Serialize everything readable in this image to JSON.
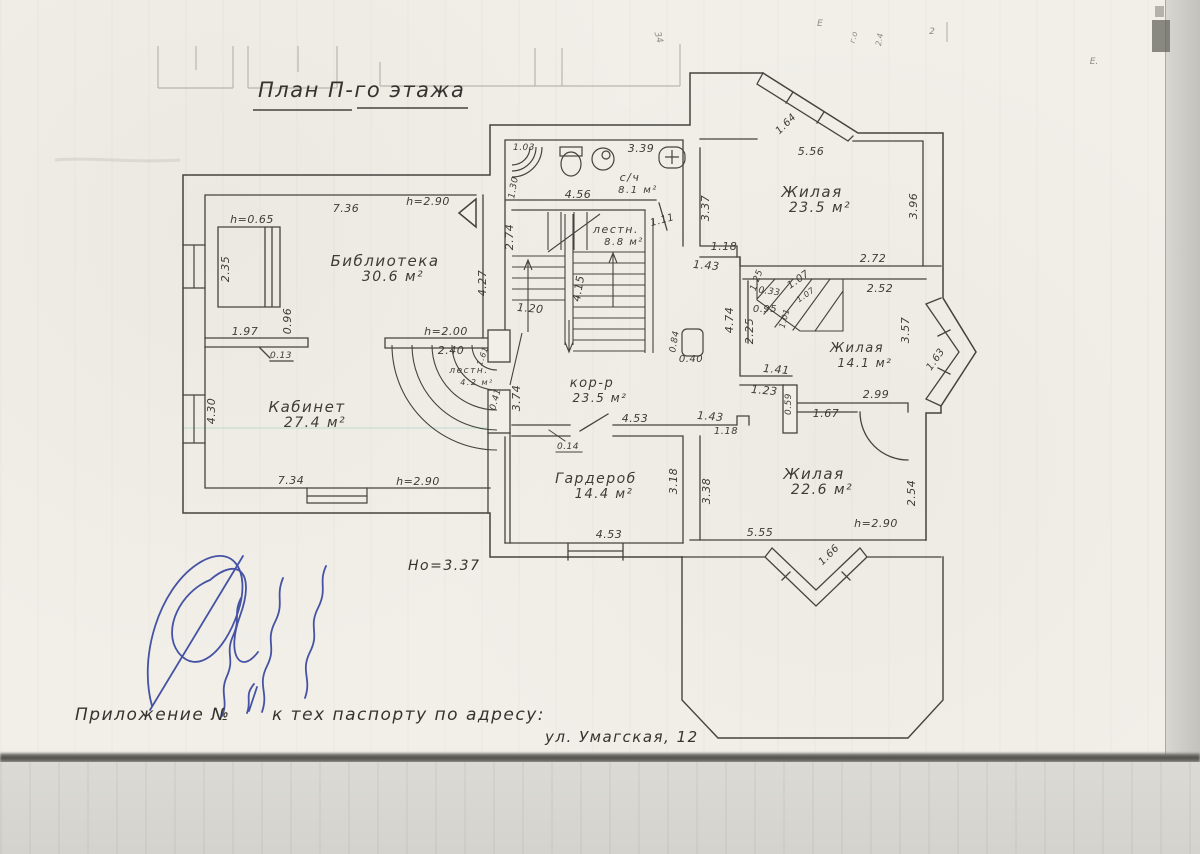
{
  "page": {
    "title": "План П-го этажа",
    "note": "Но=3.37",
    "caption_prefix": "Приложение №",
    "caption_suffix": "к тех паспорту по адресу:",
    "caption_address": "ул. Умагская, 12"
  },
  "colors": {
    "ink": "#44433e",
    "blue_ink": "#2e3e9b",
    "paper": "#f1efe8"
  },
  "rooms": [
    {
      "name": "Библиотека",
      "area": "30.6 м²",
      "x": 385,
      "y": 266,
      "fs": 15
    },
    {
      "name": "Кабинет",
      "area": "27.4 м²",
      "x": 307,
      "y": 412,
      "fs": 15
    },
    {
      "name": "с/ч",
      "area": "8.1 м²",
      "x": 630,
      "y": 181,
      "fs": 11
    },
    {
      "name": "лестн.",
      "area": "8.8 м²",
      "x": 616,
      "y": 233,
      "fs": 11
    },
    {
      "name": "лестн.",
      "area": "4.2 м²",
      "x": 469,
      "y": 373,
      "fs": 9
    },
    {
      "name": "Жилая",
      "area": "23.5 м²",
      "x": 812,
      "y": 197,
      "fs": 15
    },
    {
      "name": "Жилая",
      "area": "14.1 м²",
      "x": 857,
      "y": 352,
      "fs": 13
    },
    {
      "name": "Жилая",
      "area": "22.6 м²",
      "x": 814,
      "y": 479,
      "fs": 15
    },
    {
      "name": "Гардероб",
      "area": "14.4 м²",
      "x": 596,
      "y": 483,
      "fs": 14
    },
    {
      "name": "кор-р",
      "area": "23.5 м²",
      "x": 592,
      "y": 387,
      "fs": 13
    }
  ],
  "dims": [
    {
      "t": "7.36",
      "x": 346,
      "y": 212
    },
    {
      "t": "h=2.90",
      "x": 428,
      "y": 205
    },
    {
      "t": "h=0.65",
      "x": 252,
      "y": 223
    },
    {
      "t": "2.35",
      "x": 229,
      "y": 269,
      "r": -90
    },
    {
      "t": "0.96",
      "x": 291,
      "y": 321,
      "r": -90
    },
    {
      "t": "1.97",
      "x": 245,
      "y": 335
    },
    {
      "t": "0.13",
      "x": 281,
      "y": 358,
      "fs": 9
    },
    {
      "t": "h=2.00",
      "x": 446,
      "y": 335
    },
    {
      "t": "2.40",
      "x": 451,
      "y": 354
    },
    {
      "t": "4.27",
      "x": 486,
      "y": 283,
      "r": -90
    },
    {
      "t": "1.61",
      "x": 485,
      "y": 357,
      "r": -70,
      "fs": 8
    },
    {
      "t": "4.30",
      "x": 215,
      "y": 411,
      "r": -90
    },
    {
      "t": "7.34",
      "x": 291,
      "y": 484
    },
    {
      "t": "h=2.90",
      "x": 418,
      "y": 485
    },
    {
      "t": "1.03",
      "x": 524,
      "y": 150,
      "fs": 9
    },
    {
      "t": "1.30",
      "x": 516,
      "y": 188,
      "r": -80,
      "fs": 9
    },
    {
      "t": "3.39",
      "x": 641,
      "y": 152
    },
    {
      "t": "4.56",
      "x": 578,
      "y": 198
    },
    {
      "t": "1.11",
      "x": 663,
      "y": 223,
      "r": -15,
      "fs": 10
    },
    {
      "t": "2.74",
      "x": 513,
      "y": 237,
      "r": -90
    },
    {
      "t": "1.20",
      "x": 530,
      "y": 312,
      "r": 5
    },
    {
      "t": "4.15",
      "x": 582,
      "y": 289,
      "r": -80
    },
    {
      "t": "0.41",
      "x": 498,
      "y": 400,
      "r": -75,
      "fs": 9
    },
    {
      "t": "3.74",
      "x": 520,
      "y": 398,
      "r": -90
    },
    {
      "t": "0.84",
      "x": 677,
      "y": 342,
      "r": -80,
      "fs": 9
    },
    {
      "t": "0.40",
      "x": 691,
      "y": 362,
      "fs": 10
    },
    {
      "t": "4.74",
      "x": 733,
      "y": 320,
      "r": -90
    },
    {
      "t": "2.25",
      "x": 753,
      "y": 331,
      "r": -90
    },
    {
      "t": "0.95",
      "x": 765,
      "y": 312,
      "fs": 10
    },
    {
      "t": "0.33",
      "x": 769,
      "y": 294,
      "r": 8,
      "fs": 9
    },
    {
      "t": "1.07",
      "x": 800,
      "y": 282,
      "r": -35,
      "fs": 10
    },
    {
      "t": "1.07",
      "x": 807,
      "y": 297,
      "r": -35,
      "fs": 8
    },
    {
      "t": "1.01",
      "x": 787,
      "y": 319,
      "r": -75,
      "fs": 8
    },
    {
      "t": "1.25",
      "x": 759,
      "y": 281,
      "r": -70,
      "fs": 9
    },
    {
      "t": "3.37",
      "x": 709,
      "y": 208,
      "r": -90
    },
    {
      "t": "5.56",
      "x": 811,
      "y": 155
    },
    {
      "t": "1.64",
      "x": 788,
      "y": 126,
      "r": -45,
      "fs": 10
    },
    {
      "t": "3.96",
      "x": 917,
      "y": 206,
      "r": -90
    },
    {
      "t": "1.18",
      "x": 724,
      "y": 250
    },
    {
      "t": "1.43",
      "x": 706,
      "y": 269,
      "r": 5
    },
    {
      "t": "2.72",
      "x": 873,
      "y": 262
    },
    {
      "t": "2.52",
      "x": 880,
      "y": 292
    },
    {
      "t": "3.57",
      "x": 909,
      "y": 330,
      "r": -90
    },
    {
      "t": "1.63",
      "x": 938,
      "y": 361,
      "r": -55,
      "fs": 10
    },
    {
      "t": "1.41",
      "x": 776,
      "y": 373,
      "r": 5
    },
    {
      "t": "1.23",
      "x": 764,
      "y": 394,
      "r": 5
    },
    {
      "t": "0.59",
      "x": 791,
      "y": 404,
      "r": -90,
      "fs": 9
    },
    {
      "t": "2.99",
      "x": 876,
      "y": 398
    },
    {
      "t": "1.67",
      "x": 826,
      "y": 417
    },
    {
      "t": "4.53",
      "x": 635,
      "y": 422
    },
    {
      "t": "1.43",
      "x": 710,
      "y": 420,
      "r": 5
    },
    {
      "t": "1.18",
      "x": 726,
      "y": 434,
      "fs": 10
    },
    {
      "t": "0.14",
      "x": 568,
      "y": 449,
      "fs": 9
    },
    {
      "t": "4.53",
      "x": 609,
      "y": 538
    },
    {
      "t": "3.18",
      "x": 677,
      "y": 481,
      "r": -90
    },
    {
      "t": "3.38",
      "x": 710,
      "y": 491,
      "r": -90
    },
    {
      "t": "5.55",
      "x": 760,
      "y": 536
    },
    {
      "t": "2.54",
      "x": 915,
      "y": 493,
      "r": -90
    },
    {
      "t": "h=2.90",
      "x": 876,
      "y": 527
    },
    {
      "t": "1.66",
      "x": 831,
      "y": 557,
      "r": -45,
      "fs": 10
    }
  ],
  "artifacts": [
    {
      "t": "34",
      "x": 656,
      "y": 38,
      "r": 75,
      "fs": 9
    },
    {
      "t": "Е",
      "x": 820,
      "y": 26,
      "fs": 9
    },
    {
      "t": "г.о",
      "x": 856,
      "y": 38,
      "r": -75,
      "fs": 8
    },
    {
      "t": "2.4",
      "x": 882,
      "y": 40,
      "r": -80,
      "fs": 8
    },
    {
      "t": "2",
      "x": 932,
      "y": 34,
      "fs": 9
    },
    {
      "t": "Е.",
      "x": 1094,
      "y": 64,
      "fs": 9
    }
  ]
}
